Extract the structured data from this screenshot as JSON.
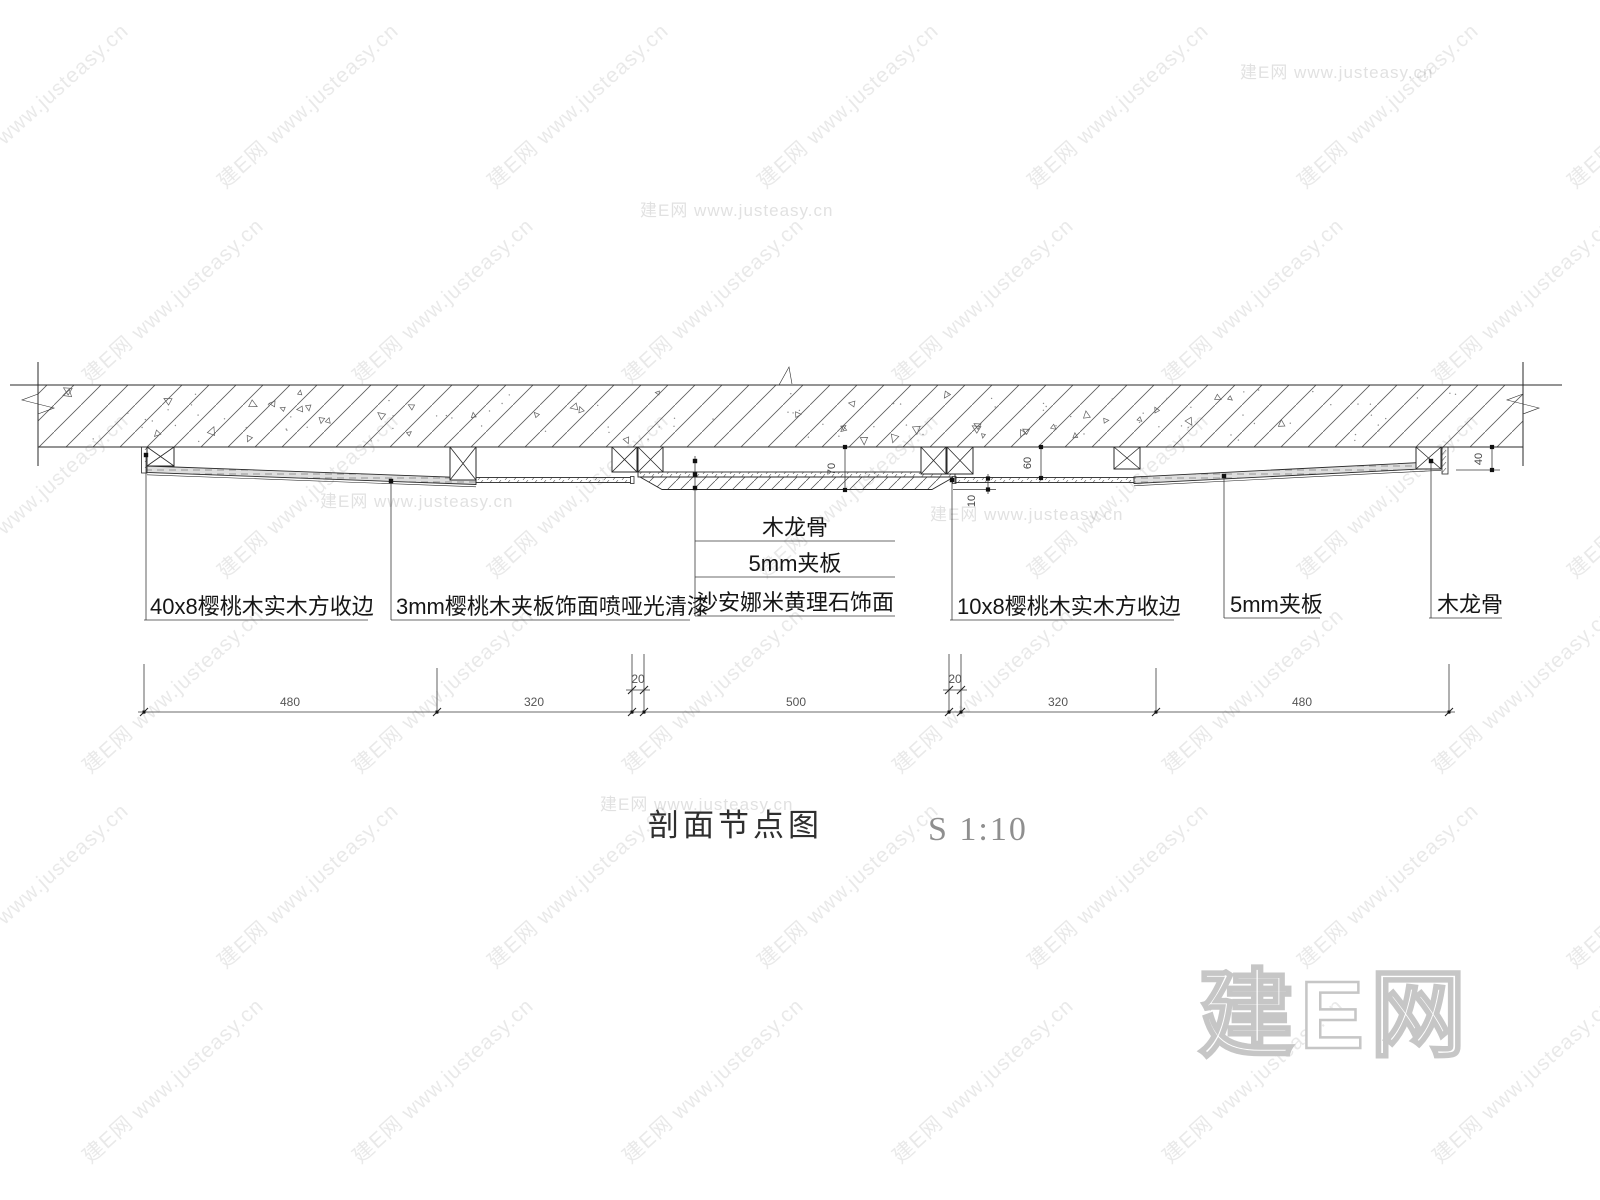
{
  "watermark": {
    "tile_text": "建E网 www.justeasy.cn",
    "logo_text": "建E网",
    "color": "#c8c8c8"
  },
  "drawing": {
    "line_color": "#2a2a2a",
    "labels": {
      "left1": "40x8樱桃木实木方收边",
      "left2": "3mm樱桃木夹板饰面喷哑光清漆",
      "center": [
        "木龙骨",
        "5mm夹板",
        "沙安娜米黄理石饰面"
      ],
      "right1": "10x8樱桃木实木方收边",
      "right2": "5mm夹板",
      "right3": "木龙骨"
    },
    "dims": {
      "chain": [
        "480",
        "320",
        "20",
        "500",
        "20",
        "320",
        "480"
      ],
      "v70": "70",
      "v60": "60",
      "v10": "10",
      "v40": "40"
    },
    "title": "剖面节点图",
    "scale_label": "S 1:10"
  }
}
